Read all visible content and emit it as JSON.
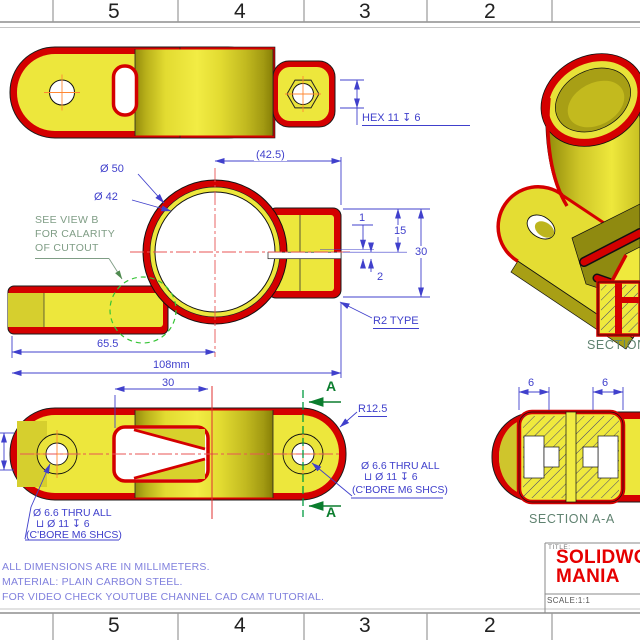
{
  "sheet": {
    "zone_labels_top": [
      "5",
      "4",
      "3",
      "2"
    ],
    "zone_labels_bottom": [
      "5",
      "4",
      "3",
      "2"
    ]
  },
  "views": {
    "top": {
      "hex_callout": "HEX 11 ↧ 6"
    },
    "front": {
      "dim_width_ref": "(42.5)",
      "dim_dia_outer": "Ø 50",
      "dim_dia_inner": "Ø 42",
      "dim_1": "1",
      "dim_15": "15",
      "dim_30": "30",
      "dim_2": "2",
      "fillet_note": "R2 TYPE",
      "dim_65_5": "65.5",
      "dim_108": "108mm",
      "view_b_note_line1": "SEE VIEW B",
      "view_b_note_line2": "FOR CALARITY",
      "view_b_note_line3": "OF CUTOUT"
    },
    "bottom": {
      "dim_30": "30",
      "radius_note": "R12.5",
      "section_letter": "A",
      "cbore_line1": "Ø 6.6 THRU ALL",
      "cbore_line2": "⊔ Ø 11 ↧ 6",
      "cbore_line3": "(C'BORE M6 SHCS)"
    },
    "section_b": {
      "label": "SECTION"
    },
    "section_a": {
      "label": "SECTION A-A",
      "dim_left": "6",
      "dim_right": "6"
    }
  },
  "notes": {
    "line1": "ALL DIMENSIONS ARE IN MILLIMETERS.",
    "line2": "MATERIAL: PLAIN CARBON STEEL.",
    "line3": "FOR VIDEO CHECK YOUTUBE CHANNEL CAD CAM TUTORIAL."
  },
  "title_block": {
    "title_label": "TITLE:",
    "brand_line1": "SOLIDWORKS",
    "brand_line2": "MANIA",
    "scale": "SCALE:1:1"
  },
  "colors": {
    "part_edge_red": "#d40000",
    "part_fill_yellow": "#ede73c",
    "dimension_blue": "#4040cc",
    "note_lavender": "#8080dd",
    "annotation_green": "#7f9d85",
    "section_green": "#0b7d2e",
    "centerline_red": "#e85555",
    "title_red": "#e60000"
  }
}
